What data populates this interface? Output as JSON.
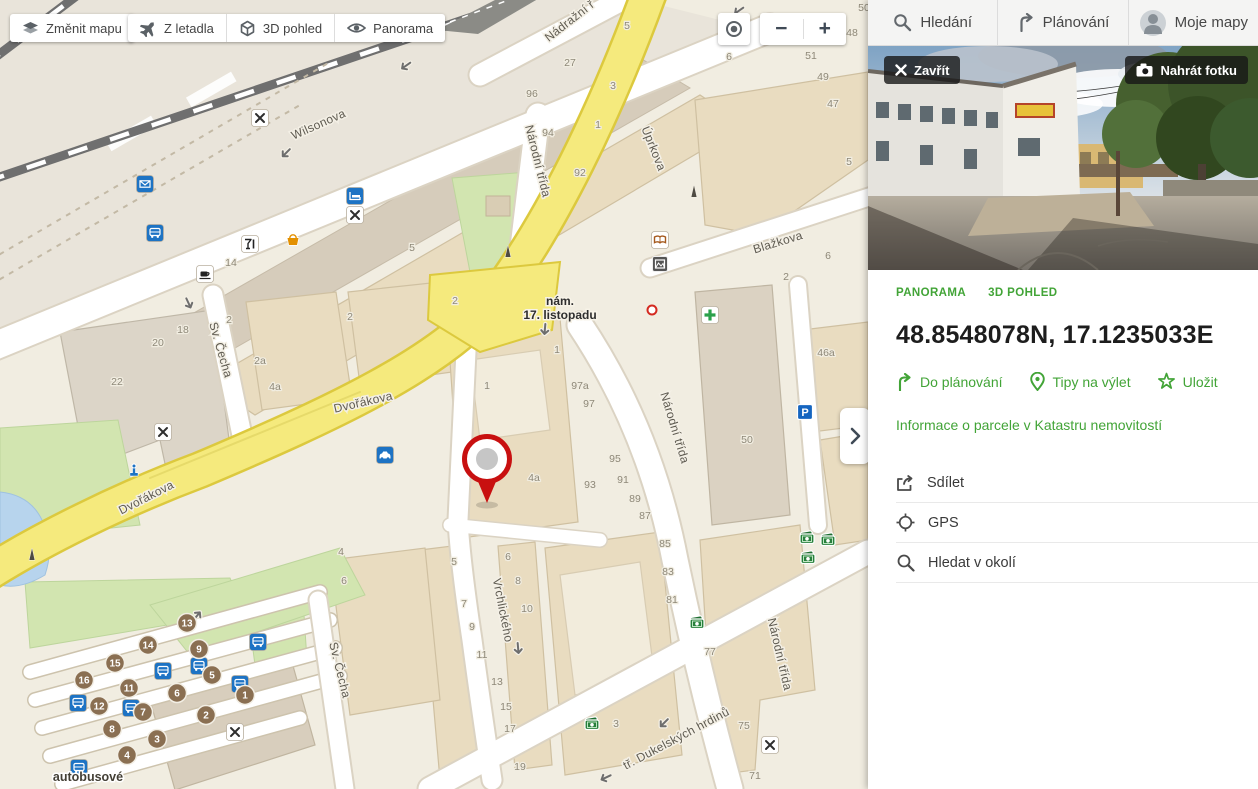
{
  "map": {
    "controls": {
      "change_map": "Změnit mapu",
      "aerial": "Z letadla",
      "view3d": "3D pohled",
      "panorama": "Panorama",
      "zoom_out": "−",
      "zoom_in": "+"
    },
    "square_label": {
      "line1": "nám.",
      "line2": "17. listopadu",
      "x": 560,
      "y": 305
    },
    "station_label": {
      "text": "autobusové",
      "x": 88,
      "y": 781
    },
    "street_labels": [
      [
        "Wilsonova",
        320,
        128,
        -24
      ],
      [
        "Nádražní ř",
        572,
        24,
        -38
      ],
      [
        "Úprkova",
        650,
        150,
        68
      ],
      [
        "Národní třída",
        534,
        162,
        76
      ],
      [
        "Blažkova",
        779,
        246,
        -17
      ],
      [
        "Dvořákova",
        148,
        501,
        -27
      ],
      [
        "Dvořákova",
        364,
        406,
        -13
      ],
      [
        "Sv. Čecha",
        217,
        351,
        74
      ],
      [
        "Sv. Čecha",
        336,
        671,
        76
      ],
      [
        "Vrchlického",
        499,
        611,
        79
      ],
      [
        "Národní třída",
        671,
        429,
        73
      ],
      [
        "Národní třída",
        776,
        655,
        77
      ],
      [
        "tř. Dukelských hrdinů",
        678,
        742,
        -28
      ]
    ],
    "house_numbers": [
      [
        "14",
        231,
        266
      ],
      [
        "5",
        412,
        251
      ],
      [
        "27",
        570,
        66
      ],
      [
        "5",
        627,
        29
      ],
      [
        "3",
        613,
        89
      ],
      [
        "96",
        532,
        97
      ],
      [
        "1",
        598,
        128
      ],
      [
        "94",
        548,
        136
      ],
      [
        "92",
        580,
        176
      ],
      [
        "6",
        729,
        60
      ],
      [
        "51",
        811,
        59
      ],
      [
        "49",
        823,
        80
      ],
      [
        "47",
        833,
        107
      ],
      [
        "5",
        849,
        165
      ],
      [
        "48",
        852,
        36
      ],
      [
        "50",
        864,
        11
      ],
      [
        "6",
        828,
        259
      ],
      [
        "2",
        786,
        280
      ],
      [
        "2",
        455,
        304
      ],
      [
        "1",
        487,
        389
      ],
      [
        "1",
        557,
        353
      ],
      [
        "97a",
        580,
        389
      ],
      [
        "97",
        589,
        407
      ],
      [
        "95",
        615,
        462
      ],
      [
        "93",
        590,
        488
      ],
      [
        "91",
        623,
        483
      ],
      [
        "89",
        635,
        502
      ],
      [
        "87",
        645,
        519
      ],
      [
        "4a",
        534,
        481
      ],
      [
        "46a",
        826,
        356
      ],
      [
        "50",
        747,
        443
      ],
      [
        "18",
        183,
        333
      ],
      [
        "20",
        158,
        346
      ],
      [
        "22",
        117,
        385
      ],
      [
        "2",
        229,
        323
      ],
      [
        "2a",
        260,
        364
      ],
      [
        "4a",
        275,
        390
      ],
      [
        "2",
        350,
        320
      ],
      [
        "4",
        341,
        555
      ],
      [
        "5",
        454,
        565
      ],
      [
        "6",
        508,
        560
      ],
      [
        "7",
        464,
        607
      ],
      [
        "8",
        518,
        584
      ],
      [
        "9",
        472,
        630
      ],
      [
        "10",
        527,
        612
      ],
      [
        "11",
        482,
        658
      ],
      [
        "13",
        497,
        685
      ],
      [
        "15",
        506,
        710
      ],
      [
        "17",
        510,
        732
      ],
      [
        "19",
        520,
        770
      ],
      [
        "85",
        665,
        547
      ],
      [
        "83",
        668,
        575
      ],
      [
        "81",
        672,
        603
      ],
      [
        "77",
        710,
        655
      ],
      [
        "75",
        744,
        729
      ],
      [
        "71",
        755,
        779
      ],
      [
        "3",
        616,
        727
      ],
      [
        "6",
        344,
        584
      ]
    ],
    "platforms": [
      [
        "13",
        187,
        623
      ],
      [
        "14",
        148,
        645
      ],
      [
        "9",
        199,
        649
      ],
      [
        "15",
        115,
        663
      ],
      [
        "16",
        84,
        680
      ],
      [
        "5",
        212,
        675
      ],
      [
        "11",
        129,
        688
      ],
      [
        "6",
        177,
        693
      ],
      [
        "1",
        245,
        695
      ],
      [
        "12",
        99,
        706
      ],
      [
        "7",
        143,
        712
      ],
      [
        "2",
        206,
        715
      ],
      [
        "8",
        112,
        729
      ],
      [
        "3",
        157,
        739
      ],
      [
        "4",
        127,
        755
      ]
    ],
    "pois": [
      [
        "restaurant",
        260,
        118
      ],
      [
        "restaurant",
        355,
        215
      ],
      [
        "restaurant",
        163,
        432
      ],
      [
        "restaurant",
        235,
        732
      ],
      [
        "restaurant",
        770,
        745
      ],
      [
        "mail",
        145,
        184
      ],
      [
        "bus",
        155,
        233
      ],
      [
        "bus",
        78,
        703
      ],
      [
        "bus",
        131,
        708
      ],
      [
        "bus",
        163,
        671
      ],
      [
        "bus",
        199,
        666
      ],
      [
        "bus",
        258,
        642
      ],
      [
        "bus",
        240,
        684
      ],
      [
        "bus",
        79,
        768
      ],
      [
        "cafe",
        205,
        274
      ],
      [
        "bar",
        250,
        244
      ],
      [
        "shop",
        293,
        240
      ],
      [
        "hotel",
        355,
        196
      ],
      [
        "taxi",
        385,
        455
      ],
      [
        "fountain",
        134,
        472
      ],
      [
        "pharmacy",
        710,
        315
      ],
      [
        "parking",
        805,
        412
      ],
      [
        "book",
        660,
        240
      ],
      [
        "museum",
        660,
        264
      ],
      [
        "monument",
        694,
        192
      ],
      [
        "monument",
        508,
        252
      ],
      [
        "monument",
        32,
        555
      ],
      [
        "atm",
        697,
        623
      ],
      [
        "atm",
        592,
        724
      ],
      [
        "atm",
        807,
        538
      ],
      [
        "atm",
        828,
        540
      ],
      [
        "atm",
        808,
        558
      ],
      [
        "ring",
        652,
        310
      ]
    ],
    "arrows": [
      [
        287,
        152,
        225
      ],
      [
        740,
        10,
        235
      ],
      [
        188,
        302,
        155
      ],
      [
        545,
        328,
        185
      ],
      [
        83,
        678,
        40
      ],
      [
        196,
        617,
        40
      ],
      [
        518,
        647,
        175
      ],
      [
        607,
        777,
        245
      ],
      [
        665,
        722,
        225
      ],
      [
        407,
        65,
        235
      ]
    ]
  },
  "sidebar": {
    "tabs": [
      {
        "label": "Hledání"
      },
      {
        "label": "Plánování"
      },
      {
        "label": "Moje mapy"
      }
    ],
    "photo": {
      "close": "Zavřít",
      "upload": "Nahrát fotku"
    },
    "view_tabs": [
      "PANORAMA",
      "3D POHLED"
    ],
    "title": "48.8548078N, 17.1235033E",
    "actions": [
      "Do plánování",
      "Tipy na výlet",
      "Uložit"
    ],
    "cadastre_link": "Informace o parcele v Katastru nemovitostí",
    "menu": [
      "Sdílet",
      "GPS",
      "Hledat v okolí"
    ]
  },
  "colors": {
    "accent_green": "#42a437",
    "road_yellow": "#f5ea7d",
    "pin_red": "#c81010",
    "poi_blue": "#1d73c4"
  }
}
